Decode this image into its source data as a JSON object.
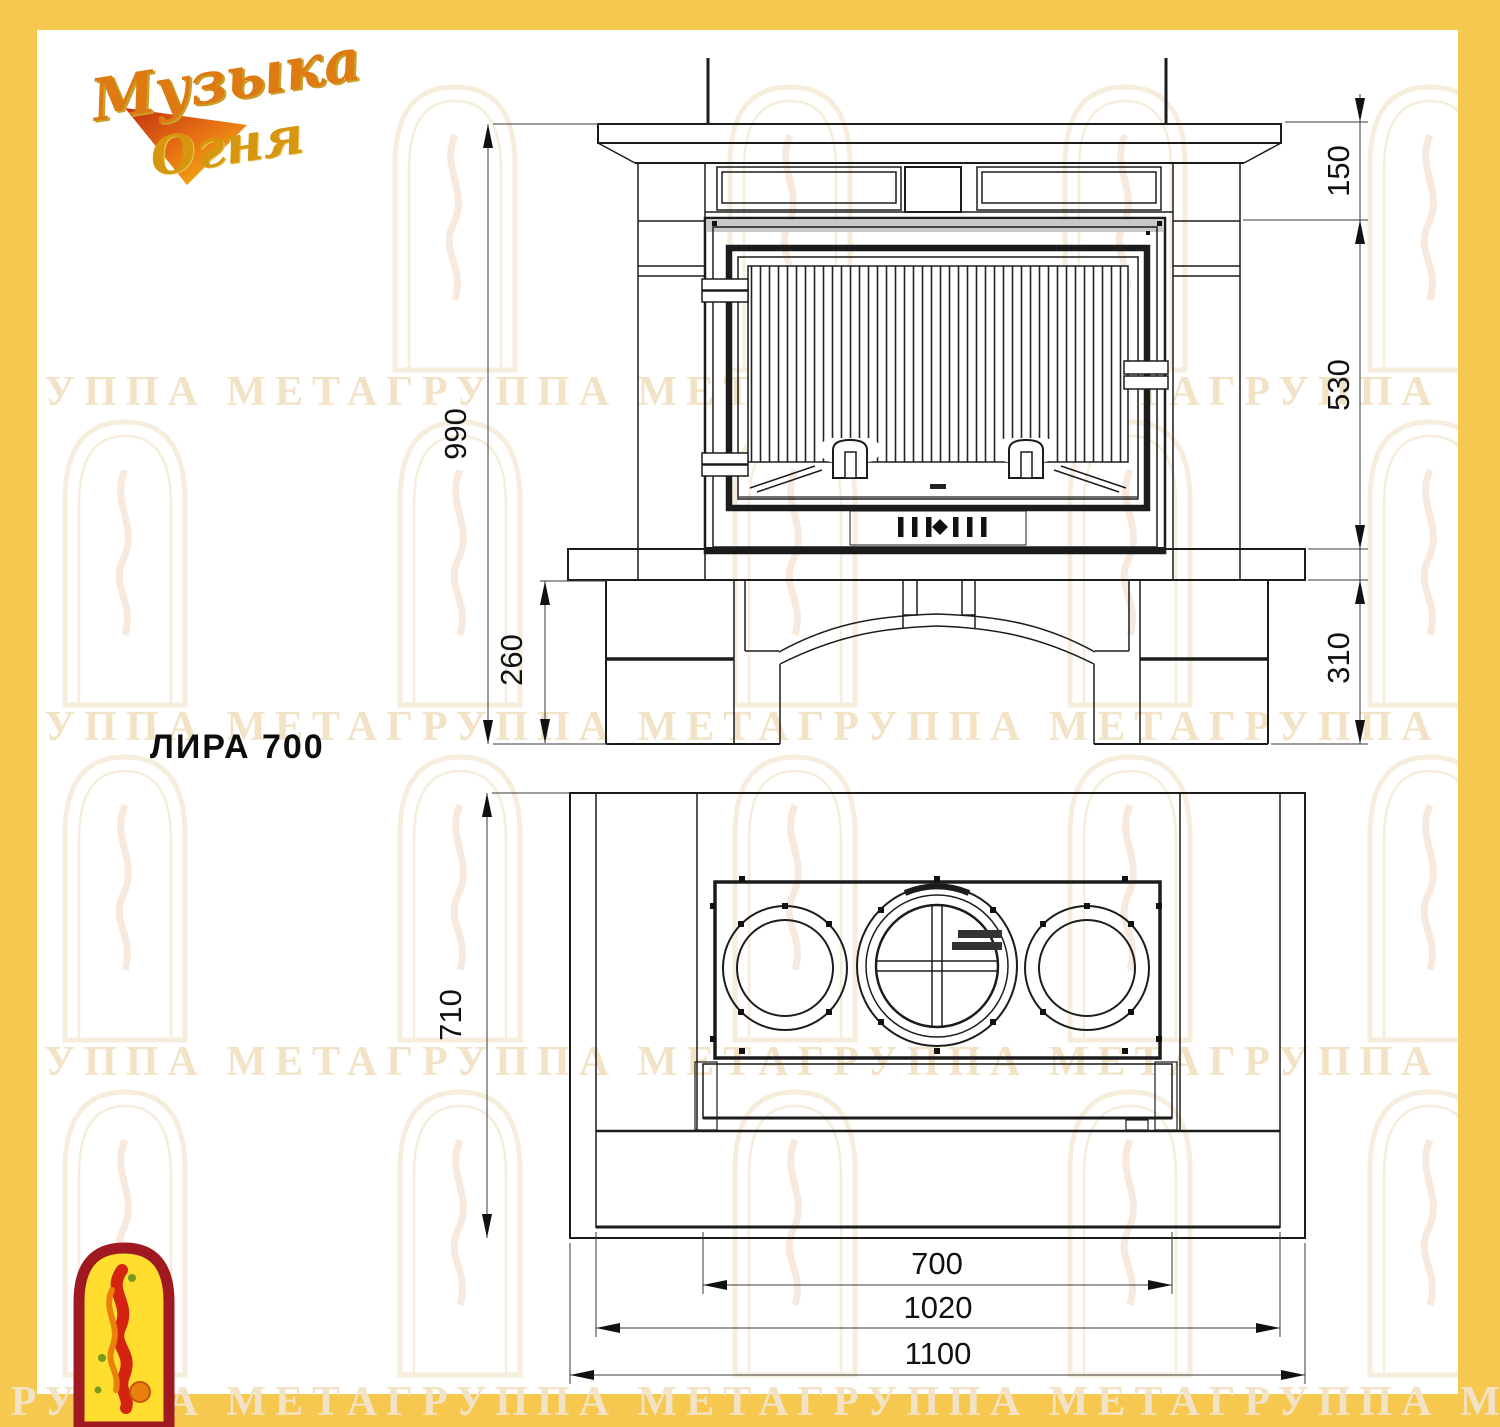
{
  "frame": {
    "color": "#F7C84F"
  },
  "logo": {
    "line1": "Музыка",
    "line2": "Огня"
  },
  "title": "ЛИРА 700",
  "watermark": {
    "text": "ГРУППА МЕТАГРУППА МЕТАГРУППА МЕТАГРУППА МЕТА"
  },
  "dimensions": {
    "front": {
      "shelf_height": "150",
      "opening_height": "530",
      "hearth_to_floor": "310",
      "total_height": "990",
      "base_height": "260"
    },
    "plan": {
      "depth": "710",
      "insert_width": "700",
      "inner_width": "1020",
      "overall_width": "1100"
    }
  }
}
